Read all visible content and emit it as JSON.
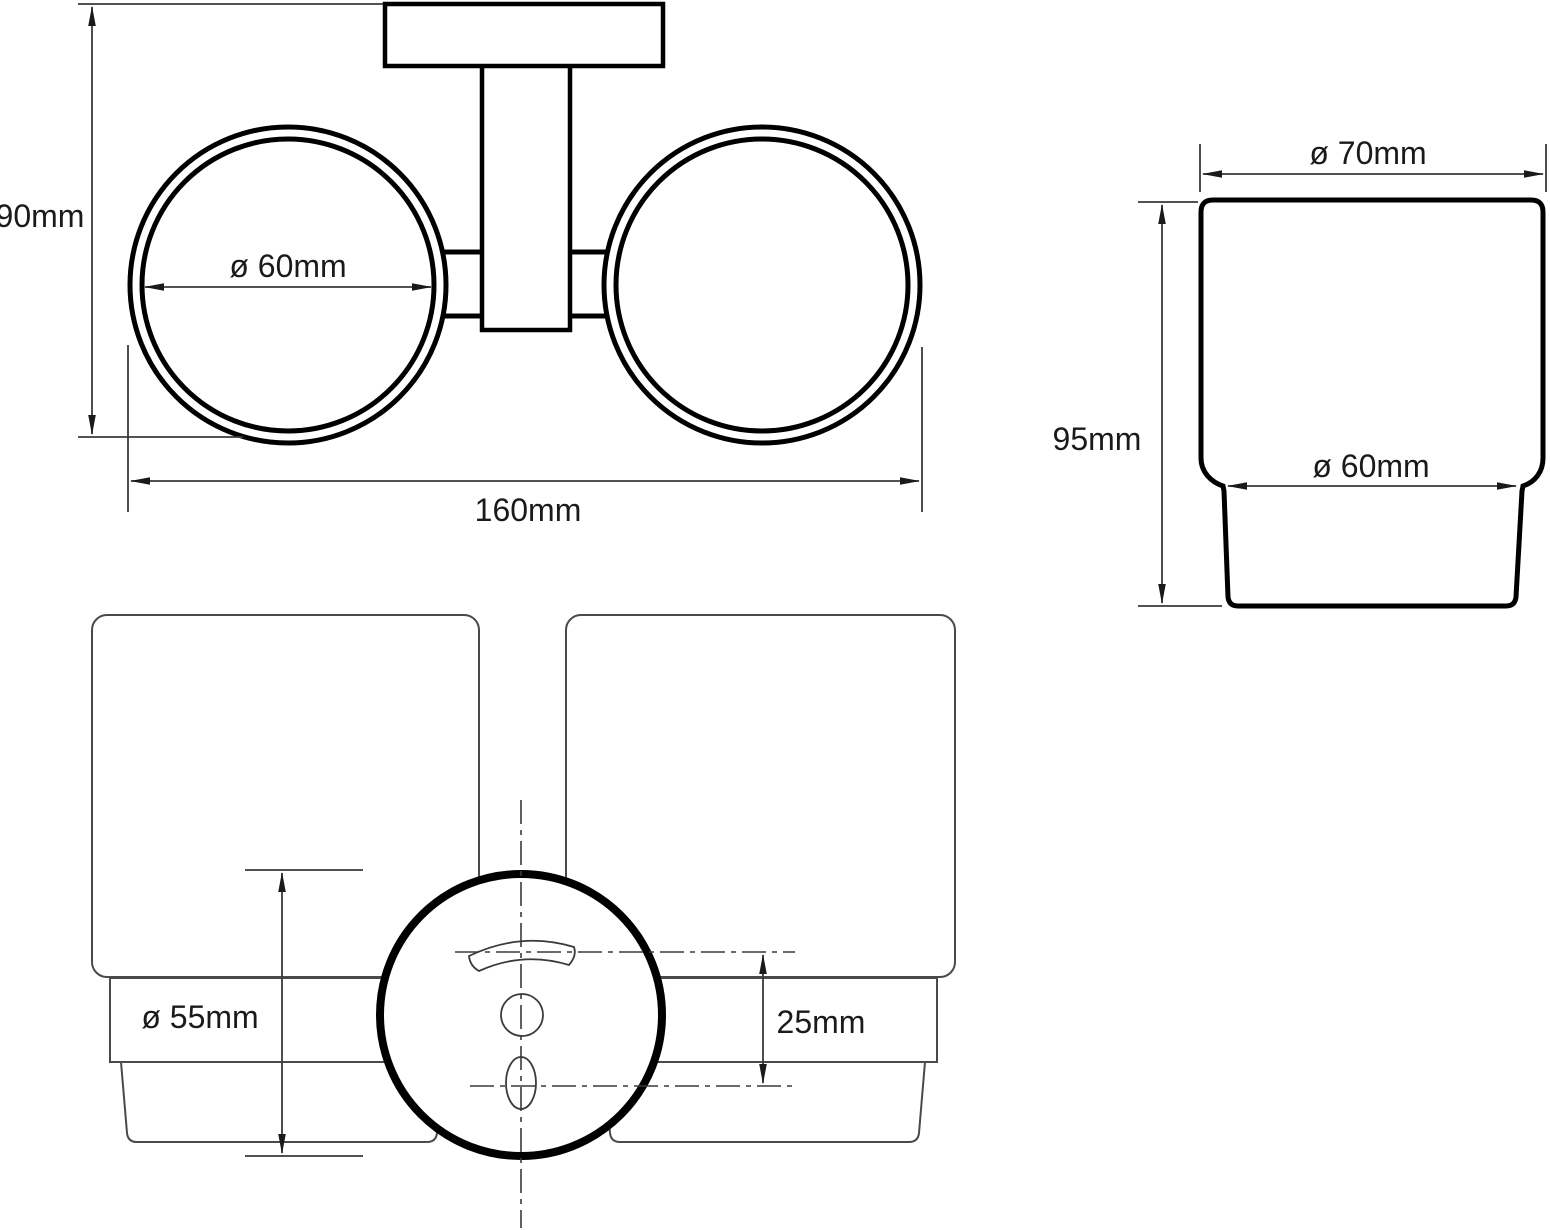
{
  "drawing": {
    "kind": "technical-dimension-drawing",
    "subject": "double glass tumbler holder",
    "colors": {
      "background": "#ffffff",
      "object_line": "#000000",
      "thin_line": "#4a4a4a",
      "dimension_line": "#3a3a3a",
      "text": "#1a1a1a"
    },
    "views": {
      "top_view": {
        "dim_height": "90mm",
        "dim_inner_diameter": "ø 60mm",
        "dim_overall_width": "160mm"
      },
      "cup_side_view": {
        "dim_top_diameter": "ø 70mm",
        "dim_height": "95mm",
        "dim_body_diameter": "ø 60mm"
      },
      "front_view": {
        "dim_cup_diameter": "ø 55mm",
        "dim_hole_spacing": "25mm"
      }
    }
  }
}
